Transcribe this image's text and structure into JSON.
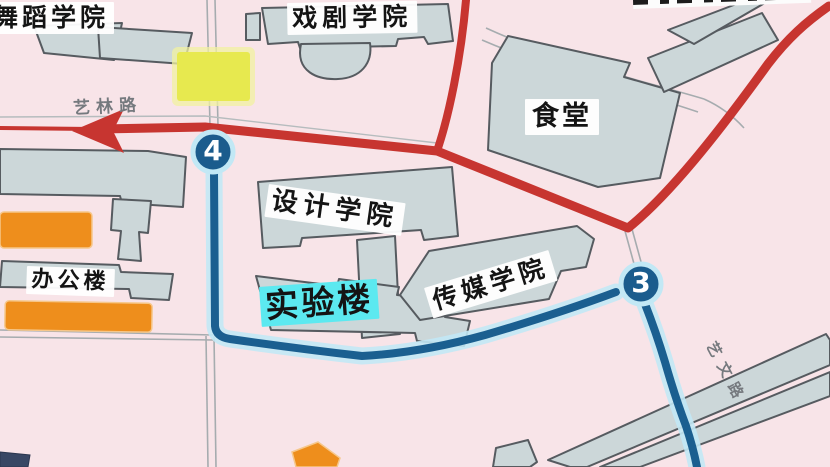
{
  "map": {
    "type": "campus-map",
    "background_color": "#f8e4e8",
    "buildings": {
      "dance_academy": "舞蹈学院",
      "drama_academy": "戏剧学院",
      "canteen": "食堂",
      "design_academy": "设计学院",
      "media_academy": "传媒学院",
      "lab_building": "实验楼",
      "office_building": "办公楼"
    },
    "roads": {
      "yilin_road": "艺林路",
      "yiwen_road": "艺文路"
    },
    "route_stops": [
      {
        "id": "stop-4",
        "label": "4"
      },
      {
        "id": "stop-3",
        "label": "3"
      }
    ],
    "colors": {
      "red_route": "#c73530",
      "blue_route": "#1b5f90",
      "blue_route_halo": "#c2e8f5",
      "stop_marker_fill": "#1b5c8d",
      "building_fill": "#ccd7d9",
      "building_stroke": "#565b60",
      "orange_building": "#ee8e1c",
      "yellow_marker": "#e7e94f",
      "lab_label_highlight": "#5ce9f0",
      "minor_road_line": "#a6acaf",
      "road_label_text": "#75797e"
    }
  }
}
